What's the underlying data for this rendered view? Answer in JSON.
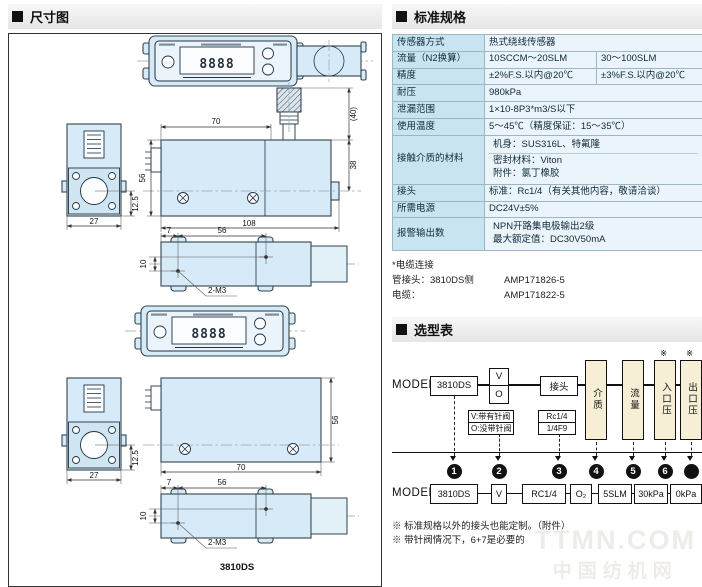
{
  "dimension_section": {
    "title": "尺寸图",
    "caption": "3810DS",
    "display_digits": "8888",
    "dims": {
      "top_width": "70",
      "body_height": "56",
      "total_length": "108",
      "end_width": "27",
      "port_offset": "12.5",
      "valve_height": "(40)",
      "outlet_height": "38",
      "hole_offset_x": "7",
      "hole_pitch": "56",
      "hole_offset_y": "10",
      "hole_label": "2-M3",
      "body_width": "70"
    }
  },
  "spec_section": {
    "title": "标准规格",
    "rows": [
      {
        "label": "传感器方式",
        "value": "热式绕线传感器"
      },
      {
        "label": "流量（N2换算）",
        "value1": "10SCCM～20SLM",
        "value2": "30～100SLM"
      },
      {
        "label": "精度",
        "value1": "±2%F.S.以内@20℃",
        "value2": "±3%F.S.以内@20℃"
      },
      {
        "label": "耐压",
        "value": "980kPa"
      },
      {
        "label": "泄漏范围",
        "value": "1×10-8P3*m3/S以下"
      },
      {
        "label": "使用温度",
        "value": "5～45℃（精度保证：15～35℃）"
      },
      {
        "label": "接触介质的材料",
        "line1": "机身：SUS316L、特氟隆",
        "line2": "密封材料：Viton",
        "line3": "附件：氯丁橡胶"
      },
      {
        "label": "接头",
        "value": "标准：Rc1/4（有关其他内容，敬请洽谈）"
      },
      {
        "label": "所需电源",
        "value": "DC24V±5%"
      },
      {
        "label": "报警输出数",
        "line1": "NPN开路集电极输出2级",
        "line2": "最大额定值：DC30V50mA"
      }
    ],
    "cable_note": {
      "title": "*电缆连接",
      "rows": [
        {
          "label": "管接头：3810DS侧",
          "value": "AMP171826-5"
        },
        {
          "label": "电缆：",
          "value": "AMP171822-5"
        }
      ]
    }
  },
  "model_section": {
    "title": "选型表",
    "model_label": "MODEL",
    "flow": {
      "base": "3810DS",
      "valve_top": "V",
      "valve_bottom": "O",
      "fitting": "接头",
      "medium": "介质",
      "flow_rate": "流量",
      "inlet": "入口压",
      "outlet": "出口压",
      "star": "※",
      "valve_note1": "V:带有针阀",
      "valve_note2": "O:没带针阀",
      "fitting_opt1": "Rc1/4",
      "fitting_opt2": "1/4F9"
    },
    "circles": [
      "1",
      "2",
      "3",
      "4",
      "5",
      "6",
      ""
    ],
    "example": [
      "3810DS",
      "V",
      "RC1/4",
      "O₂",
      "5SLM",
      "30kPa",
      "0kPa"
    ],
    "notes": [
      "※ 标准规格以外的接头也能定制。（附件）",
      "※ 带针阀情况下，6+7是必要的"
    ]
  },
  "watermark": {
    "line1": "TTMN.COM",
    "line2": "中国纺机网"
  }
}
